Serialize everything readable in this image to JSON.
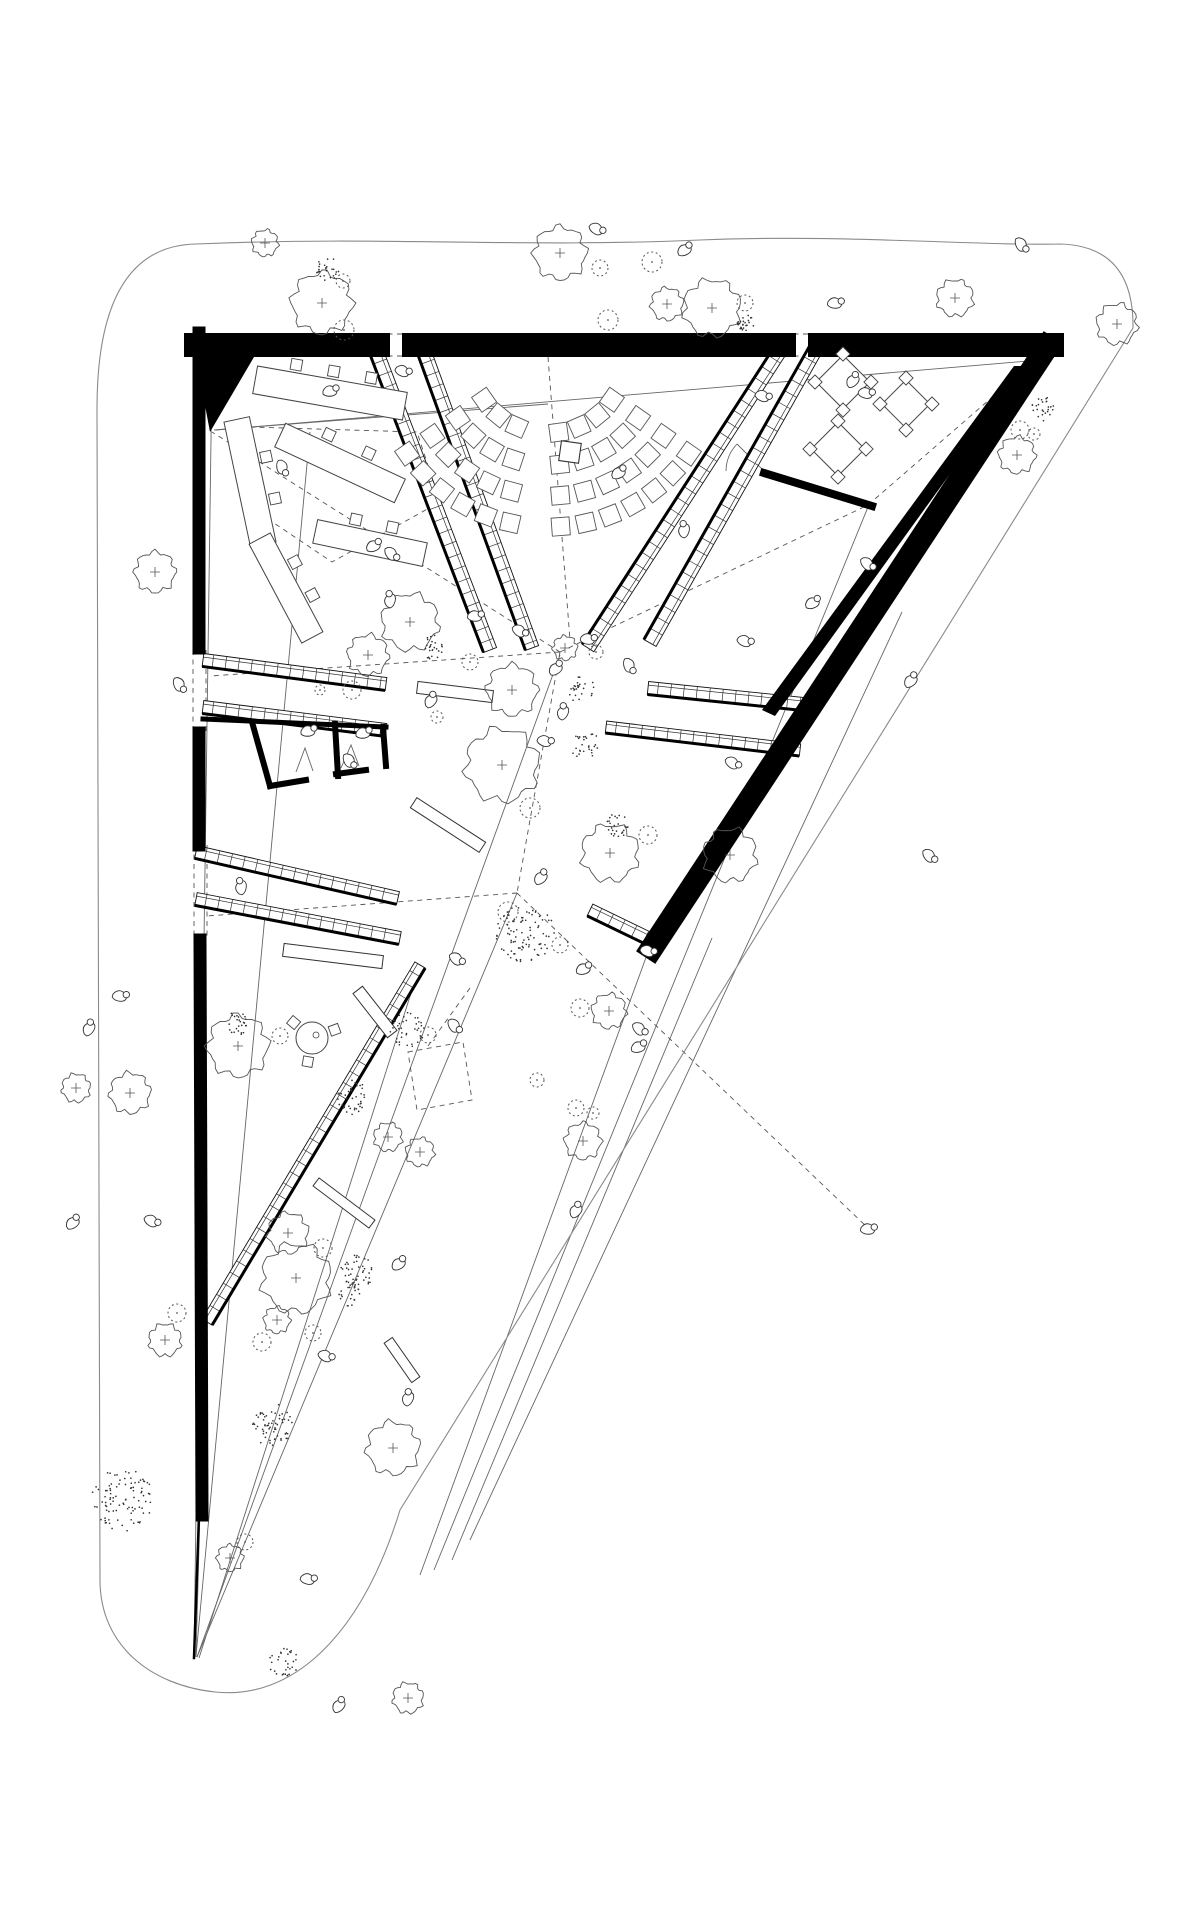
{
  "drawing": {
    "title": "triangular-pavilion-site-plan",
    "canvas": {
      "w": 1200,
      "h": 1920
    },
    "colors": {
      "background": "#ffffff",
      "walls": "#000000",
      "lines": "#666666",
      "dashed": "#555555",
      "boundary": "#8a8a8a",
      "vegetation": "#444444"
    },
    "site": {
      "path": "M196,244 C390,236 520,248 700,240 C840,234 980,246 1060,244 Q1134,246 1133,328 L400,1510 C360,1640 290,1700 215,1692 C150,1685 100,1645 100,1580 L97,412 Q96,246 196,244 Z"
    },
    "lines": {
      "thin": [
        [
          212,
          368,
          194,
          1656
        ],
        [
          310,
          432,
          196,
          1656
        ],
        [
          560,
          655,
          197,
          1657
        ],
        [
          517,
          893,
          197,
          1657
        ],
        [
          216,
          430,
          1040,
          360
        ],
        [
          1030,
          374,
          656,
          956
        ],
        [
          648,
          952,
          420,
          1575
        ],
        [
          712,
          938,
          452,
          1560
        ],
        [
          205,
          1325,
          196,
          1657
        ],
        [
          420,
          965,
          199,
          1658
        ],
        [
          214,
          430,
          548,
          404
        ],
        [
          868,
          507,
          434,
          1570
        ],
        [
          902,
          612,
          470,
          1540
        ]
      ],
      "thin_polys": [
        [
          [
            296,
            772
          ],
          [
            305,
            748
          ],
          [
            313,
            771
          ]
        ],
        [
          [
            341,
            768
          ],
          [
            351,
            745
          ],
          [
            359,
            766
          ]
        ],
        [
          [
            766,
            473
          ],
          [
            737,
            444
          ]
        ]
      ],
      "dashed": [
        [
          560,
          652,
          212,
          432
        ],
        [
          548,
          357,
          570,
          640
        ],
        [
          560,
          652,
          868,
          505
        ],
        [
          868,
          505,
          768,
          473
        ],
        [
          868,
          505,
          1042,
          354
        ],
        [
          560,
          652,
          517,
          893
        ],
        [
          560,
          652,
          210,
          676
        ],
        [
          517,
          893,
          207,
          916
        ],
        [
          517,
          893,
          868,
          1228
        ],
        [
          470,
          988,
          428,
          1046
        ],
        [
          378,
          334,
          414,
          334
        ],
        [
          378,
          356,
          414,
          356
        ],
        [
          784,
          334,
          820,
          334
        ],
        [
          784,
          356,
          820,
          356
        ],
        [
          193,
          650,
          193,
          731
        ],
        [
          206,
          650,
          206,
          731
        ],
        [
          194,
          845,
          194,
          940
        ],
        [
          207,
          845,
          207,
          940
        ]
      ],
      "dashed_polys": [
        [
          [
            250,
            427
          ],
          [
            417,
            432
          ],
          [
            440,
            502
          ],
          [
            332,
            562
          ],
          [
            250,
            507
          ]
        ],
        [
          [
            408,
            1052
          ],
          [
            463,
            1042
          ],
          [
            472,
            1100
          ],
          [
            417,
            1110
          ]
        ]
      ]
    },
    "walls": {
      "strokes": [
        {
          "pts": [
            [
              196,
              345
            ],
            [
              378,
              345
            ]
          ],
          "w": 24
        },
        {
          "pts": [
            [
              414,
              345
            ],
            [
              784,
              345
            ]
          ],
          "w": 24
        },
        {
          "pts": [
            [
              820,
              345
            ],
            [
              1052,
              345
            ]
          ],
          "w": 24
        },
        {
          "pts": [
            [
              199,
              333
            ],
            [
              199,
              648
            ]
          ],
          "w": 13
        },
        {
          "pts": [
            [
              199,
              733
            ],
            [
              199,
              845
            ]
          ],
          "w": 13
        },
        {
          "pts": [
            [
              200,
              940
            ],
            [
              202,
              1515
            ]
          ],
          "w": 13
        },
        {
          "pts": [
            [
              1047,
              347
            ],
            [
              652,
              948
            ]
          ],
          "w": 23
        },
        {
          "pts": [
            [
              764,
              473
            ],
            [
              872,
              506
            ]
          ],
          "w": 8
        },
        {
          "pts": [
            [
              203,
              719
            ],
            [
              386,
              727
            ]
          ],
          "w": 5
        },
        {
          "pts": [
            [
              252,
              722
            ],
            [
              270,
              786
            ]
          ],
          "w": 6
        },
        {
          "pts": [
            [
              270,
              786
            ],
            [
              306,
              780
            ]
          ],
          "w": 6
        },
        {
          "pts": [
            [
              336,
              774
            ],
            [
              366,
              770
            ]
          ],
          "w": 6
        },
        {
          "pts": [
            [
              335,
              724
            ],
            [
              338,
              776
            ]
          ],
          "w": 6
        },
        {
          "pts": [
            [
              383,
              727
            ],
            [
              386,
              766
            ]
          ],
          "w": 6
        },
        {
          "pts": [
            [
              199,
              1515
            ],
            [
              194,
              1658
            ]
          ],
          "w": 2.5
        }
      ],
      "polys": [
        [
          [
            196,
            357
          ],
          [
            254,
            357
          ],
          [
            210,
            432
          ]
        ],
        [
          [
            1014,
            366
          ],
          [
            1028,
            366
          ],
          [
            775,
            716
          ],
          [
            762,
            710
          ]
        ],
        [
          [
            1020,
            333
          ],
          [
            1056,
            333
          ],
          [
            1044,
            362
          ],
          [
            1028,
            362
          ]
        ]
      ]
    },
    "ramps": [
      [
        372,
        340,
        490,
        650,
        14,
        1
      ],
      [
        420,
        340,
        532,
        648,
        14,
        1
      ],
      [
        787,
        340,
        588,
        648,
        14,
        1
      ],
      [
        821,
        340,
        650,
        643,
        14,
        1
      ],
      [
        203,
        660,
        386,
        684,
        13,
        1
      ],
      [
        203,
        707,
        386,
        730,
        13,
        1
      ],
      [
        196,
        852,
        398,
        898,
        13,
        1
      ],
      [
        196,
        899,
        400,
        938,
        13,
        1
      ],
      [
        420,
        965,
        207,
        1322,
        12,
        -1
      ],
      [
        648,
        688,
        813,
        705,
        13,
        1
      ],
      [
        606,
        727,
        800,
        750,
        12,
        1
      ],
      [
        590,
        910,
        652,
        940,
        13,
        1
      ]
    ],
    "benches": [
      [
        455,
        692,
        76,
        12,
        7
      ],
      [
        448,
        825,
        82,
        12,
        33
      ],
      [
        333,
        956,
        100,
        13,
        7
      ],
      [
        375,
        1012,
        56,
        12,
        52
      ],
      [
        344,
        1203,
        70,
        10,
        37
      ],
      [
        402,
        1360,
        48,
        10,
        55
      ]
    ],
    "desks": [
      [
        330,
        393,
        152,
        28,
        10,
        3
      ],
      [
        340,
        463,
        132,
        26,
        25,
        2
      ],
      [
        250,
        482,
        128,
        26,
        78,
        2
      ],
      [
        286,
        588,
        112,
        24,
        62,
        2
      ],
      [
        370,
        543,
        112,
        24,
        12,
        2
      ]
    ],
    "tables": [
      [
        843,
        382,
        38
      ],
      [
        906,
        404,
        34
      ],
      [
        838,
        449,
        38
      ]
    ],
    "round_table": [
      312,
      1038,
      16
    ],
    "fan": {
      "cx": 548,
      "cy": 355,
      "rows": [
        [
          78,
          8
        ],
        [
          110,
          10
        ],
        [
          141,
          12
        ],
        [
          172,
          14
        ]
      ],
      "a0": 35,
      "a1": 145,
      "seat": 18,
      "aisle": 96,
      "aisle_half": 4.5
    },
    "lectern": [
      570,
      452,
      20,
      8
    ],
    "doors": {
      "arcs": [
        "M726,471 A40 40 0 0 1 737,444"
      ]
    },
    "trees": {
      "wavy": [
        [
          265,
          243,
          13
        ],
        [
          322,
          303,
          30
        ],
        [
          560,
          253,
          26
        ],
        [
          667,
          304,
          16
        ],
        [
          712,
          308,
          28
        ],
        [
          955,
          298,
          18
        ],
        [
          1117,
          324,
          20
        ],
        [
          1017,
          455,
          18
        ],
        [
          155,
          572,
          20
        ],
        [
          130,
          1093,
          20
        ],
        [
          76,
          1088,
          14
        ],
        [
          165,
          1340,
          16
        ],
        [
          410,
          622,
          28
        ],
        [
          368,
          655,
          20
        ],
        [
          512,
          690,
          25
        ],
        [
          565,
          648,
          12
        ],
        [
          502,
          765,
          36
        ],
        [
          610,
          853,
          28
        ],
        [
          730,
          855,
          26
        ],
        [
          609,
          1011,
          17
        ],
        [
          583,
          1141,
          18
        ],
        [
          238,
          1046,
          30
        ],
        [
          288,
          1233,
          20
        ],
        [
          296,
          1278,
          34
        ],
        [
          388,
          1137,
          14
        ],
        [
          420,
          1152,
          14
        ],
        [
          277,
          1320,
          13
        ],
        [
          230,
          1558,
          13
        ],
        [
          393,
          1448,
          26
        ],
        [
          408,
          1698,
          15
        ]
      ],
      "stipple": [
        [
          328,
          269,
          12
        ],
        [
          746,
          322,
          9
        ],
        [
          1043,
          409,
          13
        ],
        [
          123,
          1500,
          32
        ],
        [
          433,
          648,
          13
        ],
        [
          582,
          690,
          14
        ],
        [
          585,
          745,
          15
        ],
        [
          525,
          933,
          30
        ],
        [
          238,
          1023,
          12
        ],
        [
          353,
          1098,
          18
        ],
        [
          356,
          1272,
          18
        ],
        [
          272,
          1425,
          22
        ],
        [
          283,
          1663,
          16
        ],
        [
          618,
          825,
          12
        ],
        [
          348,
          1293,
          14
        ],
        [
          407,
          1030,
          18
        ]
      ],
      "bush": [
        [
          343,
          281,
          7
        ],
        [
          344,
          330,
          10
        ],
        [
          600,
          268,
          8
        ],
        [
          608,
          320,
          10
        ],
        [
          652,
          262,
          10
        ],
        [
          745,
          303,
          8
        ],
        [
          1020,
          430,
          9
        ],
        [
          1034,
          434,
          6
        ],
        [
          352,
          690,
          9
        ],
        [
          596,
          652,
          7
        ],
        [
          470,
          662,
          8
        ],
        [
          530,
          808,
          10
        ],
        [
          508,
          912,
          10
        ],
        [
          560,
          945,
          8
        ],
        [
          280,
          1036,
          8
        ],
        [
          323,
          1248,
          9
        ],
        [
          177,
          1313,
          9
        ],
        [
          245,
          1542,
          8
        ],
        [
          262,
          1342,
          9
        ],
        [
          313,
          1333,
          8
        ],
        [
          648,
          835,
          9
        ],
        [
          428,
          1035,
          8
        ],
        [
          580,
          1008,
          9
        ],
        [
          576,
          1108,
          8
        ],
        [
          593,
          1113,
          6
        ],
        [
          537,
          1080,
          7
        ],
        [
          320,
          690,
          5
        ],
        [
          437,
          717,
          6
        ]
      ]
    },
    "people": [
      [
        597,
        228,
        40
      ],
      [
        684,
        249,
        -20
      ],
      [
        835,
        302,
        10
      ],
      [
        1022,
        244,
        70
      ],
      [
        403,
        370,
        30
      ],
      [
        330,
        390,
        0
      ],
      [
        283,
        467,
        85
      ],
      [
        373,
        545,
        -15
      ],
      [
        392,
        553,
        60
      ],
      [
        763,
        395,
        30
      ],
      [
        852,
        380,
        -40
      ],
      [
        866,
        392,
        20
      ],
      [
        475,
        615,
        10
      ],
      [
        389,
        600,
        -70
      ],
      [
        520,
        630,
        45
      ],
      [
        555,
        668,
        -30
      ],
      [
        588,
        638,
        15
      ],
      [
        630,
        665,
        80
      ],
      [
        562,
        712,
        -60
      ],
      [
        545,
        740,
        25
      ],
      [
        430,
        700,
        -45
      ],
      [
        350,
        760,
        70
      ],
      [
        308,
        730,
        0
      ],
      [
        363,
        732,
        0
      ],
      [
        540,
        877,
        -35
      ],
      [
        457,
        958,
        50
      ],
      [
        583,
        968,
        -10
      ],
      [
        648,
        950,
        30
      ],
      [
        240,
        887,
        -75
      ],
      [
        152,
        1220,
        40
      ],
      [
        120,
        995,
        15
      ],
      [
        88,
        1028,
        -50
      ],
      [
        455,
        1025,
        65
      ],
      [
        398,
        1263,
        -25
      ],
      [
        326,
        1355,
        35
      ],
      [
        407,
        1398,
        -60
      ],
      [
        308,
        1578,
        20
      ],
      [
        338,
        1705,
        -40
      ],
      [
        868,
        563,
        55
      ],
      [
        812,
        602,
        -15
      ],
      [
        745,
        640,
        30
      ],
      [
        683,
        530,
        -70
      ],
      [
        733,
        762,
        45
      ],
      [
        930,
        855,
        60
      ],
      [
        180,
        684,
        75
      ],
      [
        72,
        1222,
        -30
      ],
      [
        575,
        1210,
        -45
      ],
      [
        868,
        1228,
        10
      ],
      [
        618,
        472,
        -20
      ],
      [
        910,
        680,
        -35
      ],
      [
        640,
        1028,
        55
      ],
      [
        638,
        1046,
        -10
      ]
    ]
  }
}
